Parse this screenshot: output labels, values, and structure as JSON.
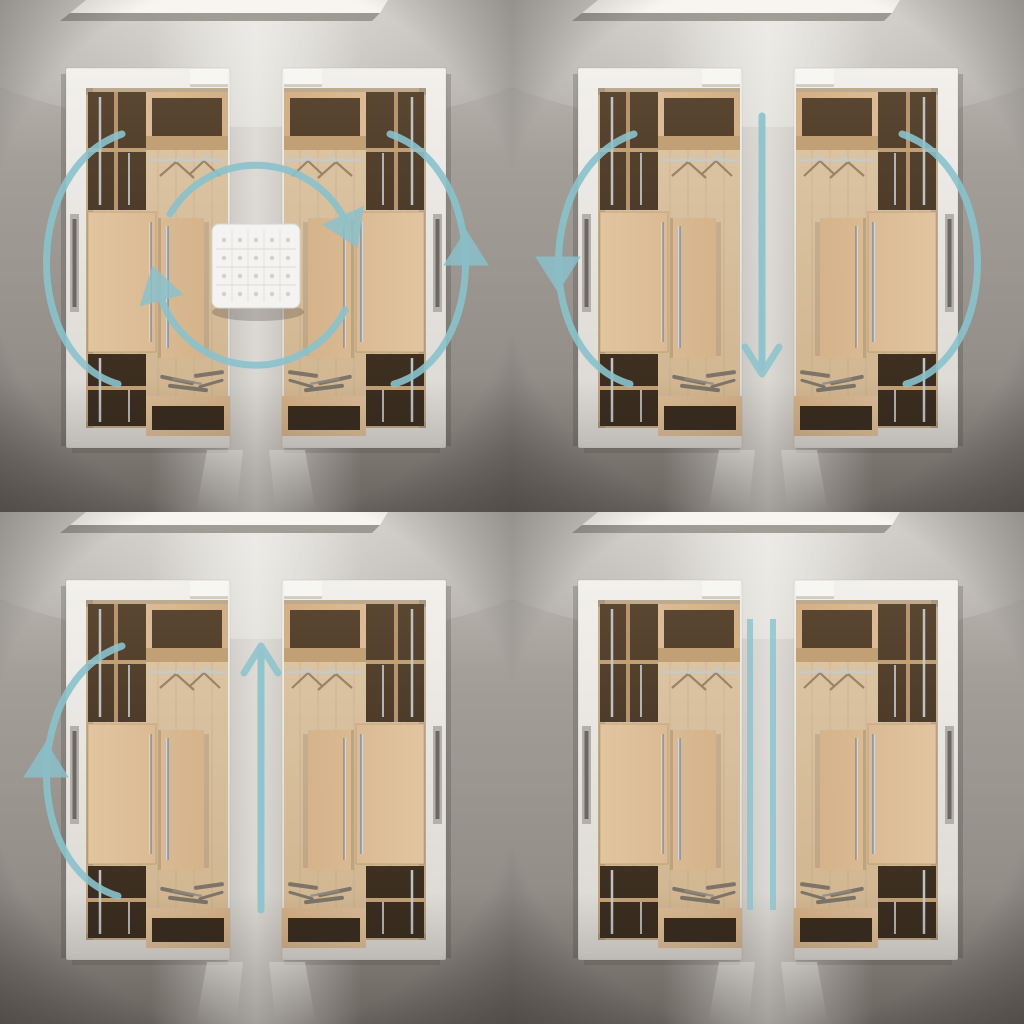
{
  "scene": {
    "description": "2x2 grid of photorealistic top-view walk-in closet renders, two mirrored wardrobe walls per panel, annotated with teal circulation-flow arrows",
    "colors": {
      "accent": "#8ac2cc",
      "concrete_top": "#c6c3bd",
      "concrete_mid": "#a39e98",
      "concrete_low": "#948f89",
      "concrete_deep": "#837e78",
      "aisle_glow": "#e8e6e1",
      "shell_white_hi": "#f2f0ec",
      "shell_white_lo": "#dad7d2",
      "floor_wood_hi": "#ddc7a7",
      "floor_wood_lo": "#d0b48f",
      "cabinet_wood_hi": "#e2c59f",
      "cabinet_wood_lo": "#d2af86",
      "cabinet_wood_deep": "#c2a076",
      "niche_brown": "#5a4631",
      "niche_brown_deep": "#36291c",
      "metal": "#c6c9cb",
      "handle_gray": "#97989a",
      "ottoman_white": "#f4f3f1",
      "ottoman_seam": "#d9d6d1",
      "skylight": "#f6f5f2",
      "skylight_frame": "#8f8b85",
      "shadow": "#3a342e",
      "shoe_gray": "#6f6960",
      "hanger_wood": "#9b8465"
    },
    "panels": [
      {
        "id": "top-left",
        "label": "closet pair with center ottoman and rotating circulation loop",
        "ottoman": true,
        "arrows": {
          "loop": true,
          "straight": null,
          "left_arc": true,
          "left_arc_head": null,
          "right_arc": true,
          "right_arc_head": "up",
          "parallel_lines": false
        }
      },
      {
        "id": "top-right",
        "label": "closet pair with one-way downward walkthrough",
        "ottoman": false,
        "arrows": {
          "loop": false,
          "straight": "down",
          "left_arc": true,
          "left_arc_head": "down",
          "right_arc": true,
          "right_arc_head": null,
          "parallel_lines": false
        }
      },
      {
        "id": "bottom-left",
        "label": "closet pair with one-way upward walkthrough",
        "ottoman": false,
        "arrows": {
          "loop": false,
          "straight": "up",
          "left_arc": true,
          "left_arc_head": "up",
          "right_arc": false,
          "right_arc_head": null,
          "parallel_lines": false
        }
      },
      {
        "id": "bottom-right",
        "label": "closet pair separated by two parallel divider lines",
        "ottoman": false,
        "arrows": {
          "loop": false,
          "straight": null,
          "left_arc": false,
          "left_arc_head": null,
          "right_arc": false,
          "right_arc_head": null,
          "parallel_lines": true
        }
      }
    ]
  }
}
